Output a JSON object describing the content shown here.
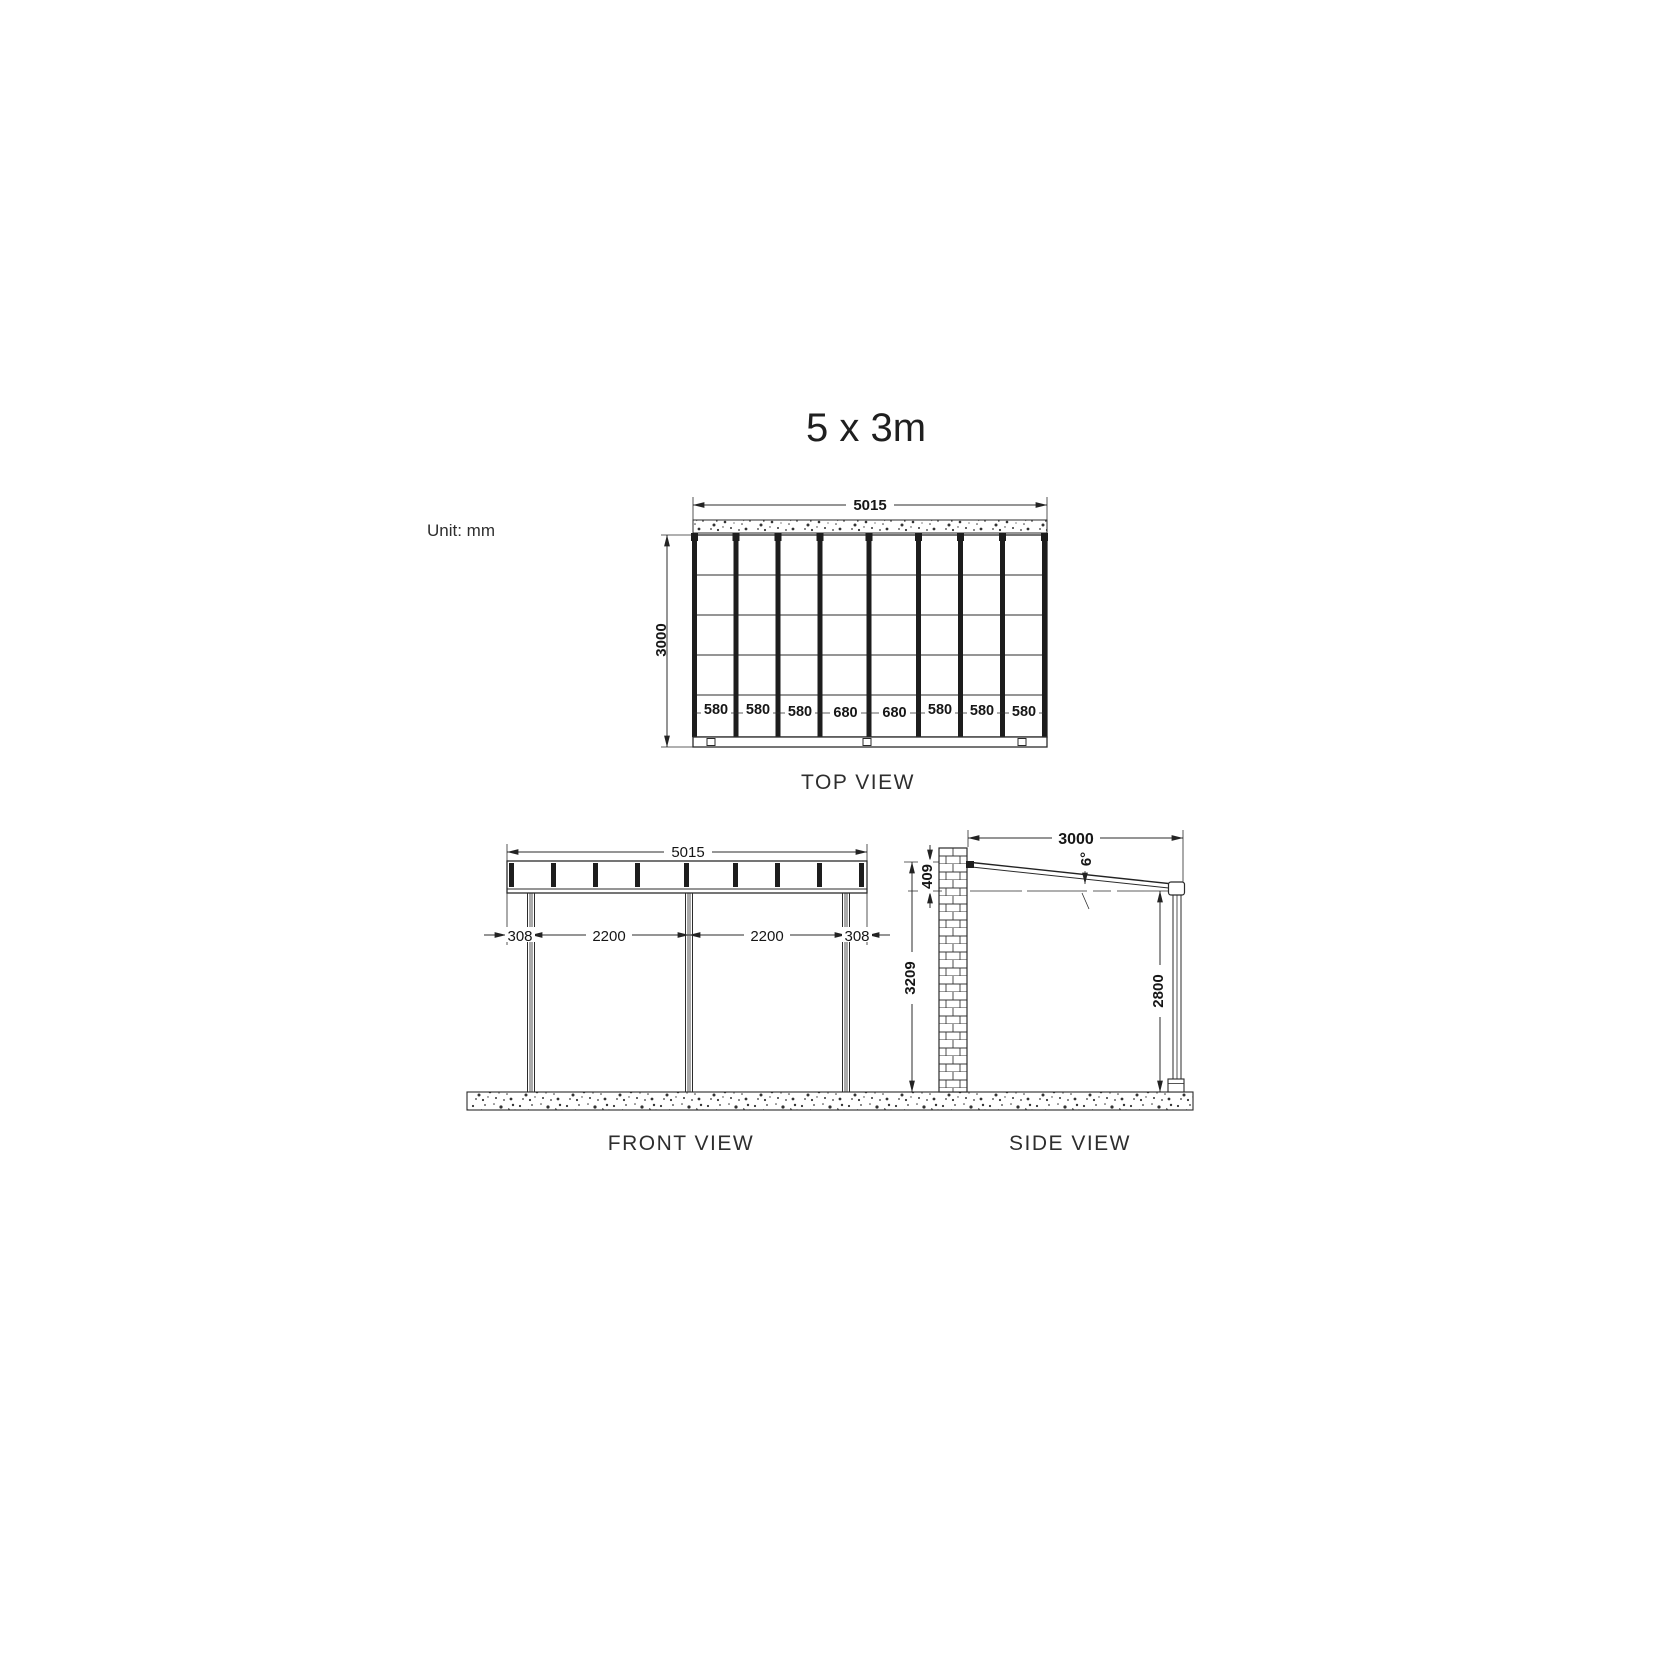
{
  "title": "5 x 3m",
  "unit_label": "Unit: mm",
  "colors": {
    "line": "#2b2b2b",
    "background": "#ffffff"
  },
  "top_view": {
    "label": "TOP VIEW",
    "width_mm": "5015",
    "depth_mm": "3000",
    "bay_widths": [
      "580",
      "580",
      "580",
      "680",
      "680",
      "580",
      "580",
      "580"
    ]
  },
  "front_view": {
    "label": "FRONT VIEW",
    "width_mm": "5015",
    "left_offset_mm": "308",
    "span_left_mm": "2200",
    "span_right_mm": "2200",
    "right_offset_mm": "308"
  },
  "side_view": {
    "label": "SIDE VIEW",
    "depth_mm": "3000",
    "rise_mm": "409",
    "total_height_mm": "3209",
    "post_height_mm": "2800",
    "roof_angle": "6°"
  }
}
